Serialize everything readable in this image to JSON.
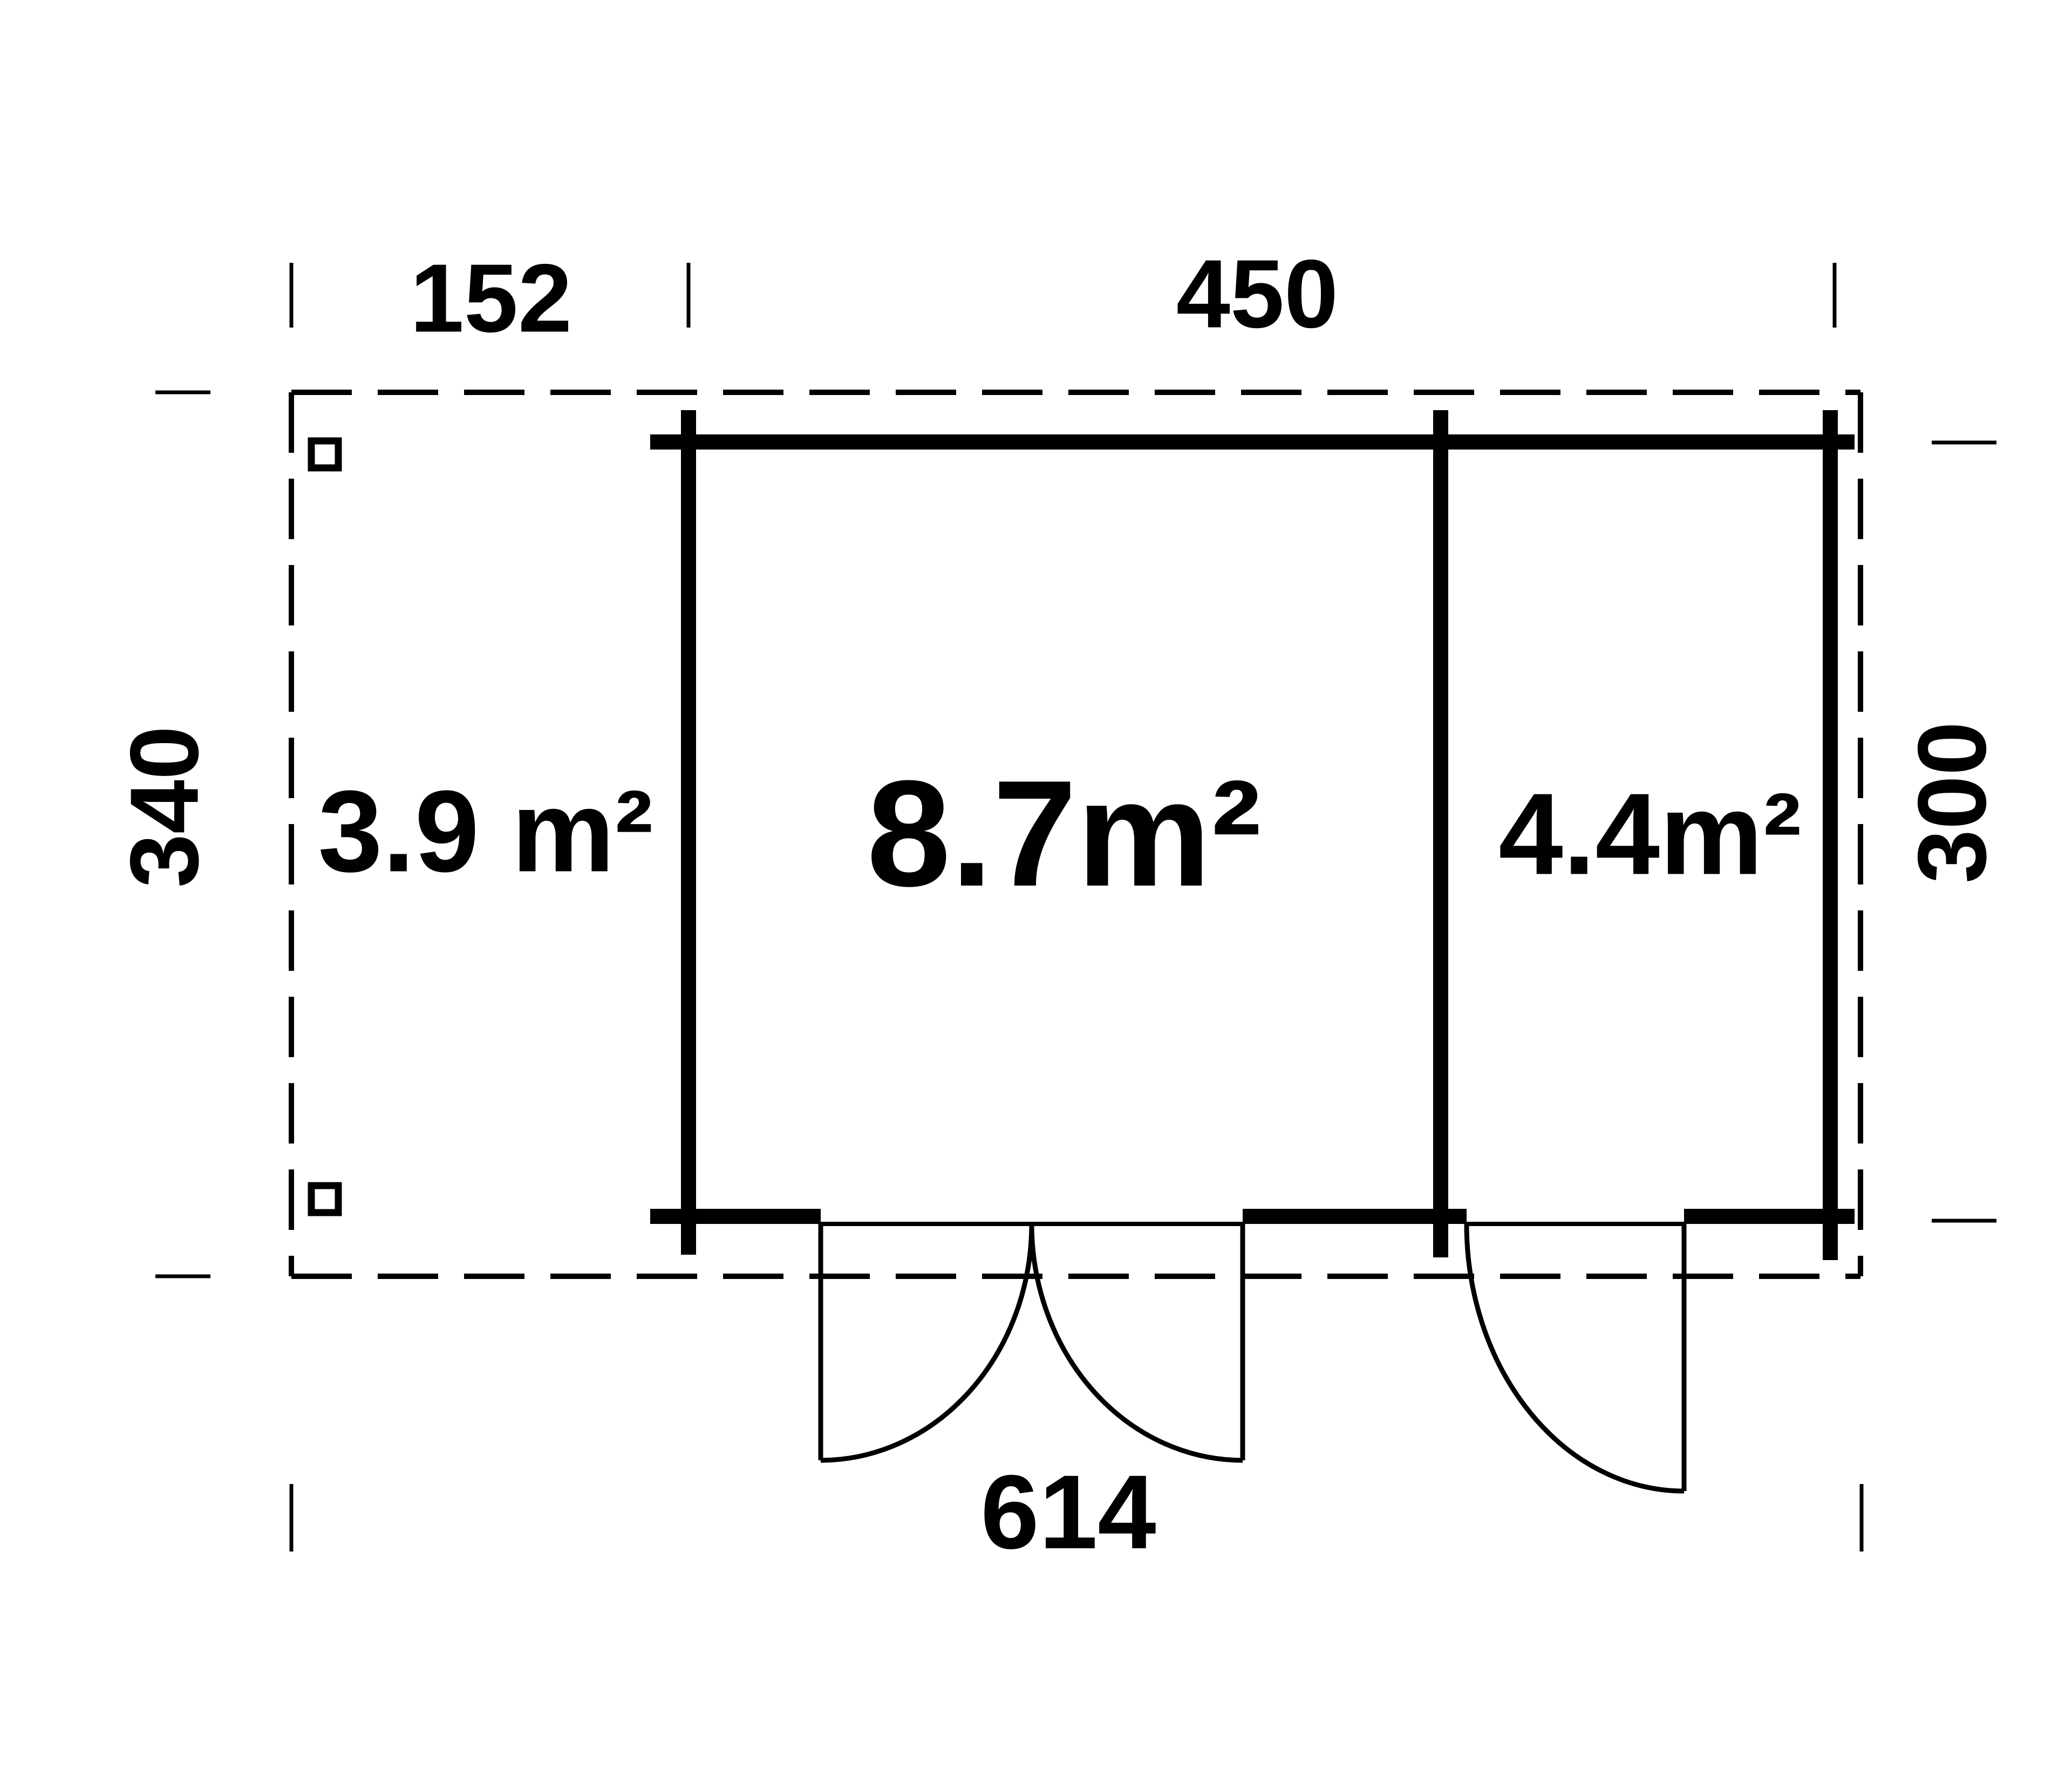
{
  "page": {
    "background_color": "#ffffff",
    "line_color": "#000000"
  },
  "floor_plan": {
    "dimension_labels": {
      "terrace_width": "152",
      "cabin_width": "450",
      "total_width": "614",
      "total_depth": "340",
      "cabin_depth": "300"
    },
    "area_labels": {
      "terrace": "3.9 m²",
      "main_room": "8.7m²",
      "side_room": "4.4m²"
    }
  }
}
